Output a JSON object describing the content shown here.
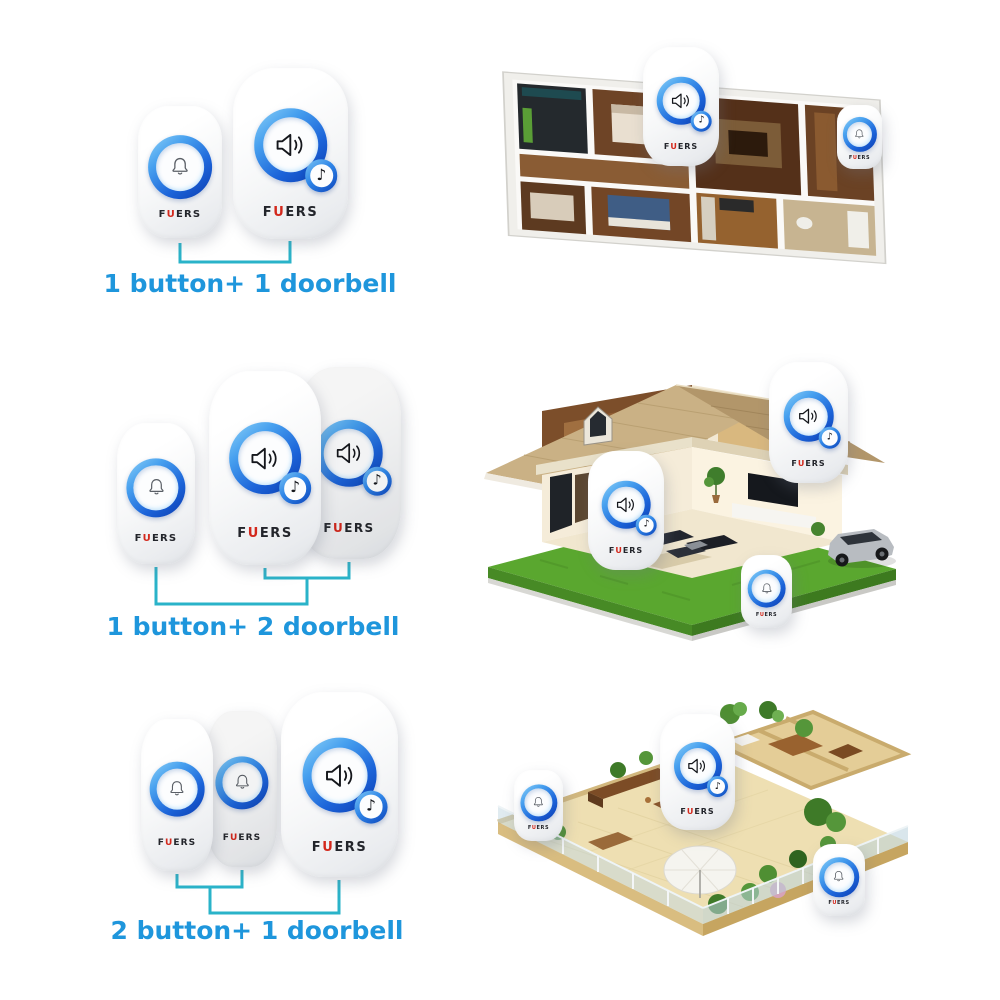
{
  "brand": {
    "logo_parts": {
      "f": "F",
      "u": "U",
      "ers": "ERS"
    },
    "accent_color": "#d3281c",
    "text_color": "#23252b"
  },
  "kits": [
    {
      "caption": "1 button+ 1 doorbell",
      "buttons": 1,
      "doorbells": 1,
      "scene": "apartment floor plan"
    },
    {
      "caption": "1 button+ 2 doorbell",
      "buttons": 1,
      "doorbells": 2,
      "scene": "two-story house cutaway"
    },
    {
      "caption": "2 button+ 1 doorbell",
      "buttons": 2,
      "doorbells": 1,
      "scene": "penthouse terrace floor plan"
    }
  ],
  "icons": {
    "bell": "bell-outline",
    "speaker": "speaker-with-sound-waves",
    "music_note": "♪"
  },
  "colors": {
    "caption_text": "#1e96dc",
    "bracket_line": "#2ab3c9",
    "ring_blue_light": "#8ed1f7",
    "ring_blue_dark": "#0b3cb0",
    "device_body": "#ffffff",
    "page_background": "#ffffff"
  }
}
